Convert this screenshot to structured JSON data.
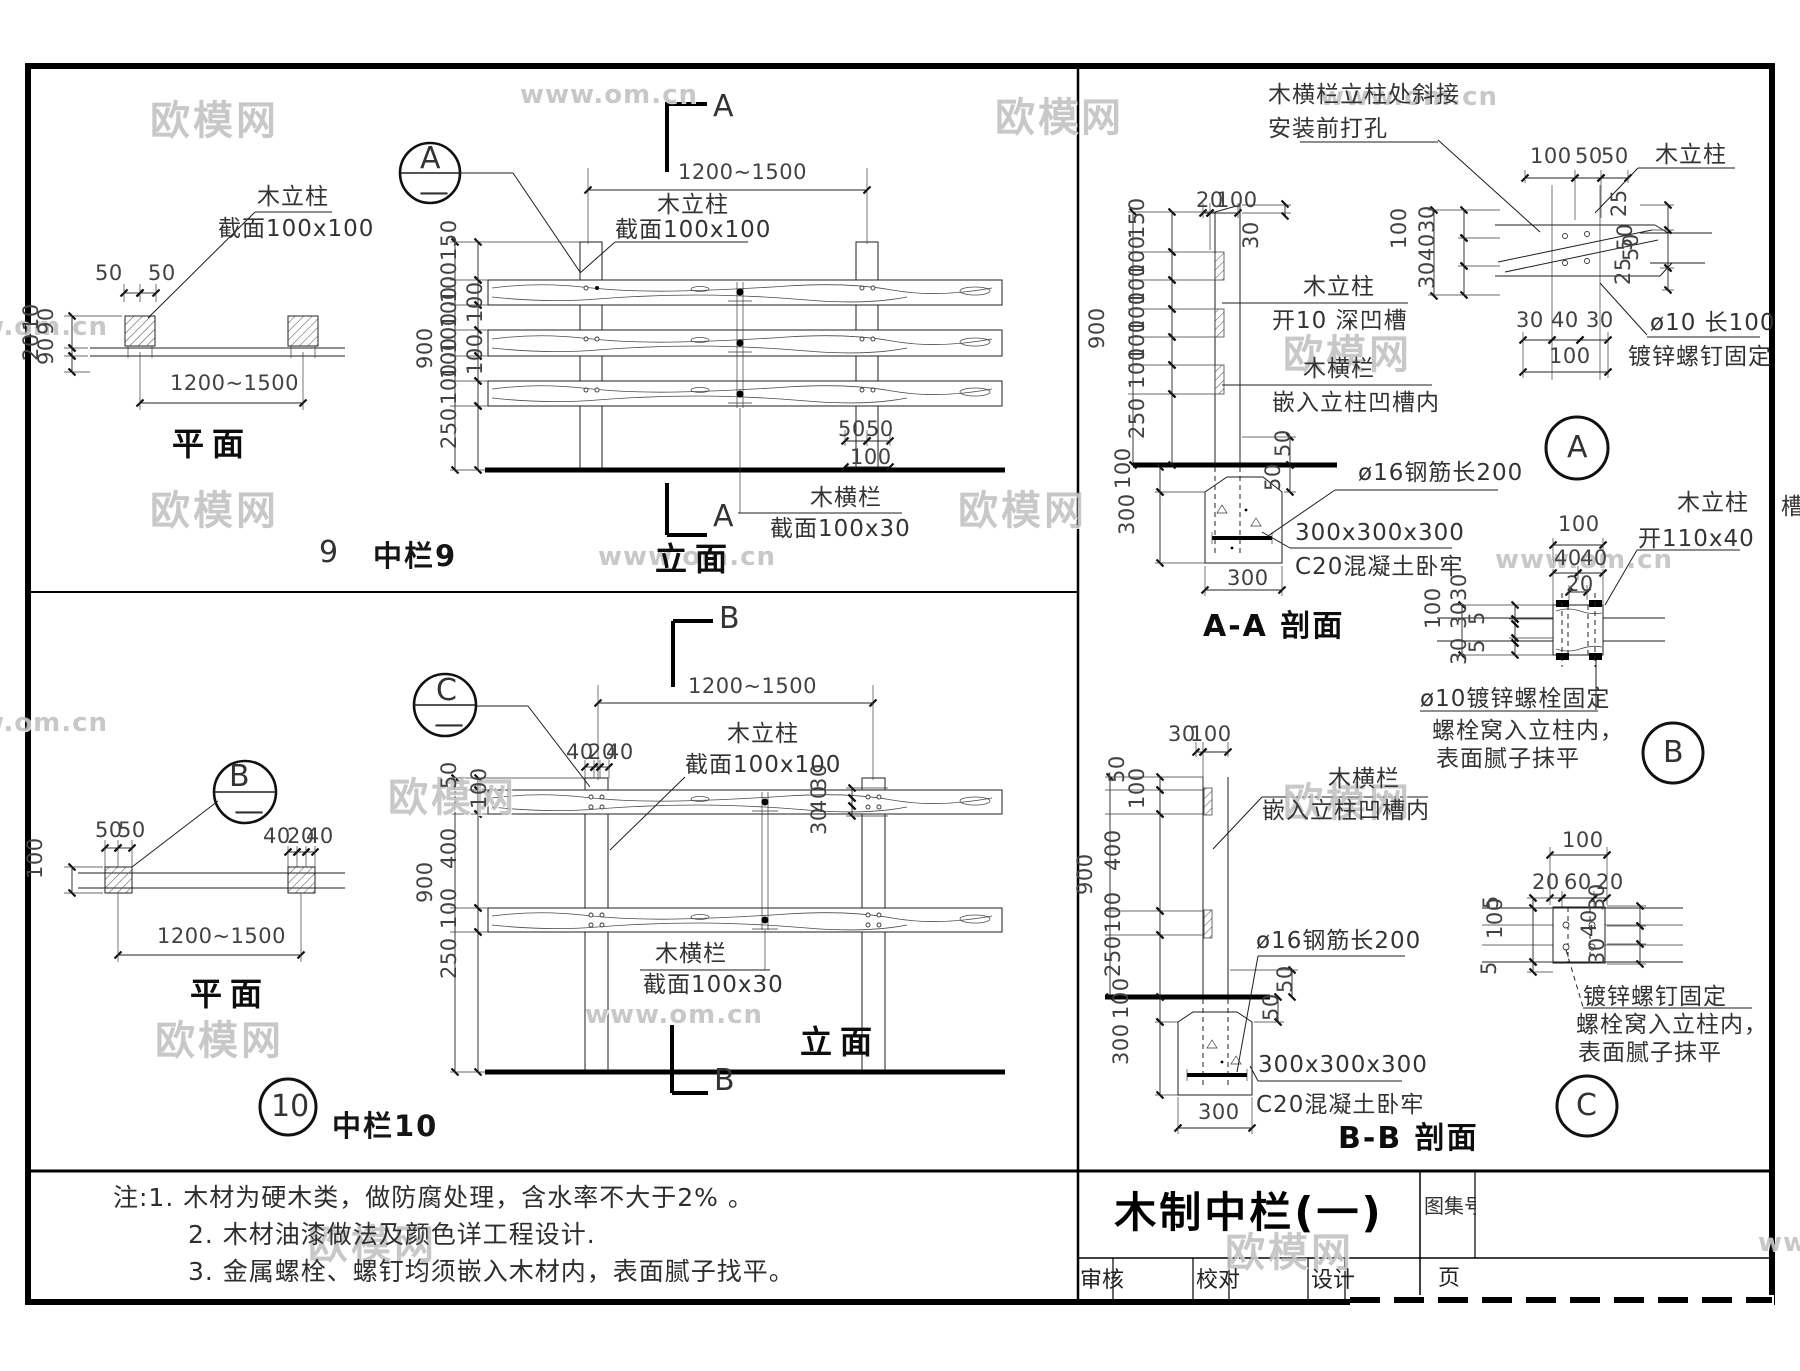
{
  "wm": {
    "brand": "欧模网",
    "url": "www.om.cn"
  },
  "sheet": {
    "edge_char": "槽",
    "notes": {
      "line1": "注:1.  木材为硬木类，做防腐处理，含水率不大于2%  。",
      "line2": "2. 木材油漆做法及颜色详工程设计.",
      "line3": "3. 金属螺栓、螺钉均须嵌入木材内，表面腻子找平。"
    },
    "title_block": {
      "title": "木制中栏(一)",
      "atlas_no_label": "图集号",
      "page_label": "页",
      "review_label": "审核",
      "proof_label": "校对",
      "design_label": "设计"
    }
  },
  "rail9": {
    "bubble": {
      "num": "9",
      "label": "中栏9"
    },
    "detail_ref": {
      "letter": "A",
      "dash": "—"
    },
    "plan": {
      "title": "平面",
      "dim_50a": "50",
      "dim_50b": "50",
      "dim_10": "10",
      "dim_90a": "90",
      "dim_20": "20",
      "dim_90b": "90",
      "dim_span": "1200~1500",
      "post_label": "木立柱",
      "post_section": "截面100x100"
    },
    "elev": {
      "title": "立面",
      "marker_top": "A",
      "marker_bottom": "A",
      "dim_span": "1200~1500",
      "post_label": "木立柱",
      "post_section": "截面100x100",
      "rail_label": "木横栏",
      "rail_section": "截面100x30",
      "dims_left": [
        "150",
        "100",
        "100",
        "100",
        "100",
        "100",
        "250"
      ],
      "dim_total": "900",
      "dims_inner": [
        "100",
        "100"
      ],
      "dim_50a": "50",
      "dim_50b": "50",
      "dim_100": "100"
    }
  },
  "rail10": {
    "bubble": {
      "num": "10",
      "label": "中栏10"
    },
    "detail_ref_b": {
      "letter": "B",
      "dash": "—"
    },
    "detail_ref_c": {
      "letter": "C",
      "dash": "—"
    },
    "plan": {
      "title": "平面",
      "dim_50a": "50",
      "dim_50b": "50",
      "dim_40a": "40",
      "dim_20": "20",
      "dim_40b": "40",
      "dim_100": "100",
      "dim_span": "1200~1500"
    },
    "elev": {
      "title": "立面",
      "marker_top": "B",
      "marker_bottom": "B",
      "dim_span": "1200~1500",
      "dims_top": [
        "40",
        "20",
        "40"
      ],
      "post_label": "木立柱",
      "post_section": "截面100x100",
      "rail_label": "木横栏",
      "rail_section": "截面100x30",
      "dims_left": [
        "50",
        "100",
        "400",
        "100",
        "250"
      ],
      "dim_total": "900",
      "dims_right": [
        "30",
        "40",
        "30"
      ]
    }
  },
  "section_aa": {
    "title": "A-A 剖面",
    "dim_20": "20",
    "dim_100": "100",
    "dim_30": "30",
    "dims_left": [
      "150",
      "100",
      "100",
      "100",
      "100",
      "100",
      "250"
    ],
    "dim_total": "900",
    "post_label": "木立柱",
    "post_note": "开10  深凹槽",
    "rail_label": "木横栏",
    "rail_note": "嵌入立柱凹槽内",
    "dim_50a": "50",
    "dim_50b": "50",
    "rebar_label": "ø16钢筋长200",
    "found_dim1": "100",
    "found_dim2": "300",
    "found_w": "300",
    "conc_size": "300x300x300",
    "conc_label": "C20混凝土卧牢"
  },
  "detail_a": {
    "letter": "A",
    "note1": "木横栏立柱处斜接",
    "note2": "安装前打孔",
    "dim_100t": "100",
    "dim_50a": "50",
    "dim_50b": "50",
    "post_label": "木立柱",
    "dims_lv": [
      "30",
      "40",
      "30"
    ],
    "dim_lv_total": "100",
    "dims_rv": [
      "25",
      "50",
      "50",
      "25"
    ],
    "dims_b": [
      "30",
      "40",
      "30"
    ],
    "dim_b_total": "100",
    "screw1": "ø10 长100",
    "screw2": "镀锌螺钉固定"
  },
  "detail_b": {
    "letter": "B",
    "post_label": "木立柱",
    "slot": "开110x40",
    "dim_100t": "100",
    "dim_40a": "40",
    "dim_40b": "40",
    "dim_20": "20",
    "dim_100l": "100",
    "dims_l": [
      "30",
      "5",
      "30",
      "5",
      "30"
    ],
    "bolt1": "ø10镀锌螺栓固定",
    "bolt2": "螺栓窝入立柱内，",
    "bolt3": "表面腻子抹平"
  },
  "section_bb": {
    "title": "B-B 剖面",
    "dim_30": "30",
    "dim_100": "100",
    "dims_left": [
      "50",
      "100",
      "400",
      "100",
      "250"
    ],
    "dim_total": "900",
    "rail_label": "木横栏",
    "rail_note": "嵌入立柱凹槽内",
    "rebar_label": "ø16钢筋长200",
    "dim_50a": "50",
    "dim_50b": "50",
    "found_dim1": "100",
    "found_dim2": "300",
    "found_w": "300",
    "conc_size": "300x300x300",
    "conc_label": "C20混凝土卧牢"
  },
  "detail_c": {
    "letter": "C",
    "dim_100t": "100",
    "dims_t": [
      "20",
      "60",
      "20"
    ],
    "dims_l": [
      "5",
      "100",
      "5"
    ],
    "dims_r": [
      "30",
      "40",
      "30"
    ],
    "screw1": "镀锌螺钉固定",
    "screw2": "螺栓窝入立柱内，",
    "screw3": "表面腻子抹平"
  }
}
